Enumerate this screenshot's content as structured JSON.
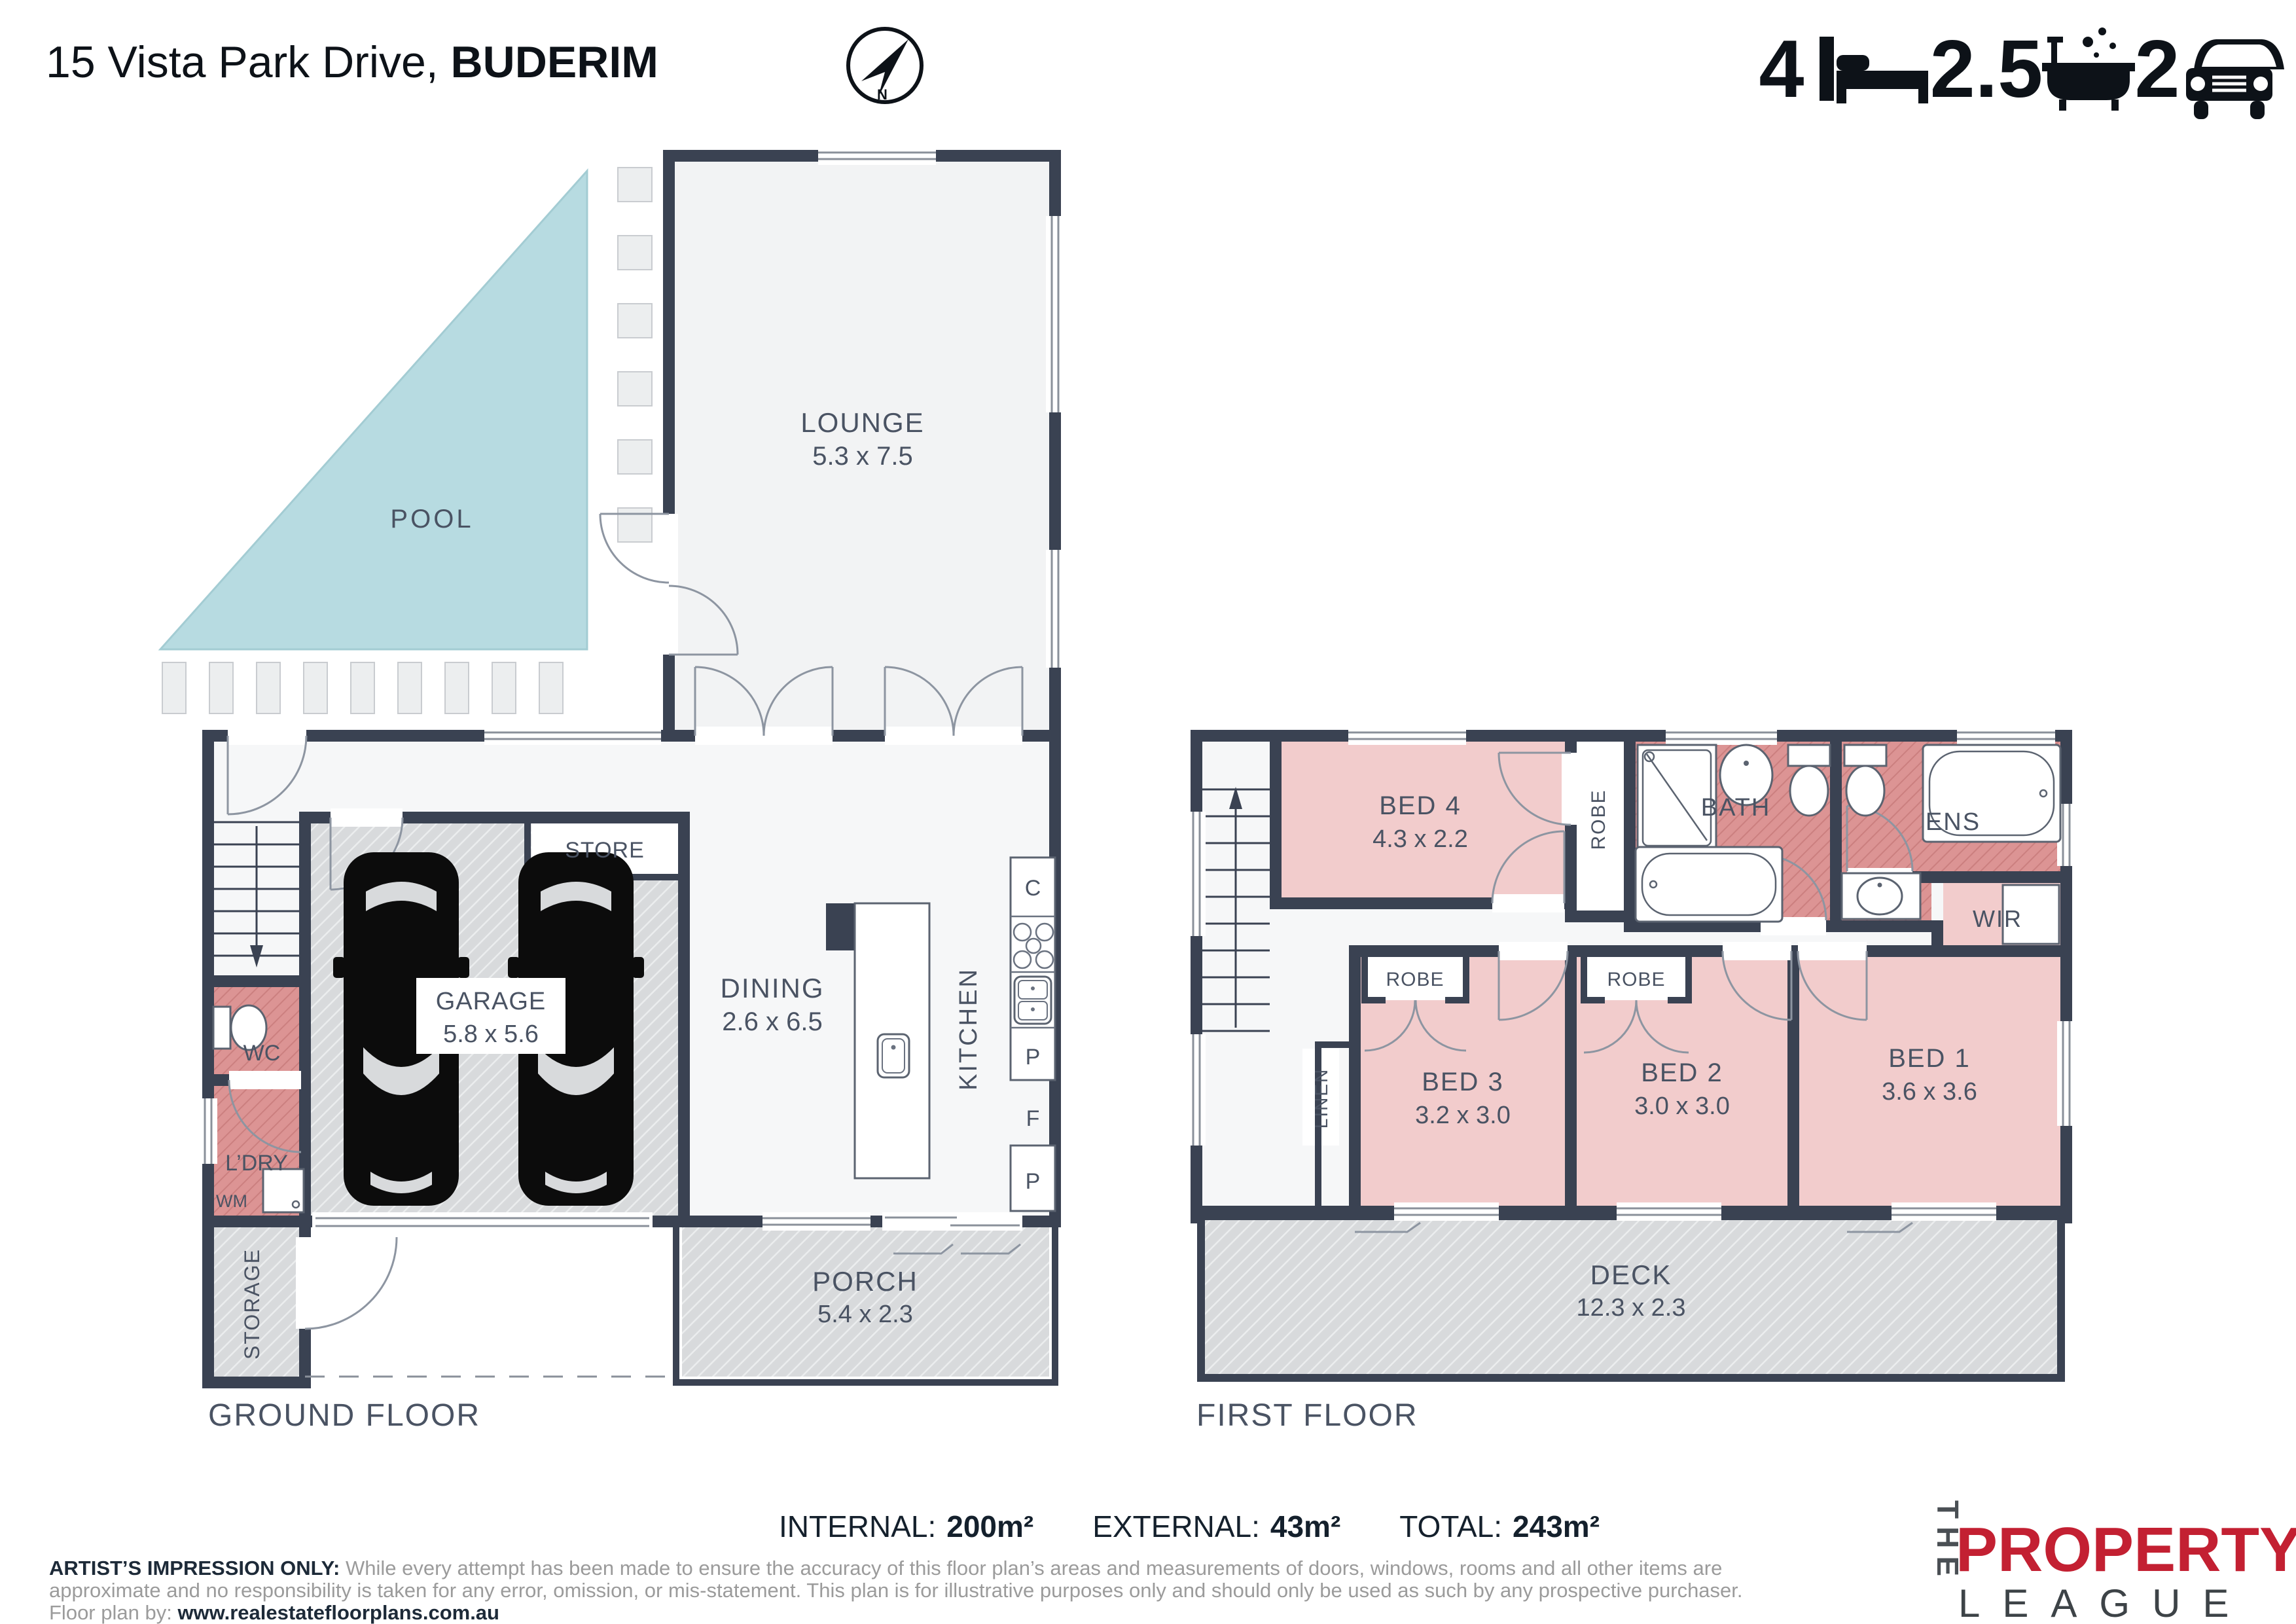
{
  "header": {
    "title_address": "15 Vista Park Drive, ",
    "title_suburb": "BUDERIM",
    "compass_n": "N",
    "stats": {
      "beds": "4",
      "baths": "2.5",
      "cars": "2"
    }
  },
  "ground_floor": {
    "floor_label": "GROUND FLOOR",
    "rooms": {
      "pool": "POOL",
      "lounge": {
        "name": "LOUNGE",
        "dims": "5.3 x 7.5"
      },
      "store": "STORE",
      "garage": {
        "name": "GARAGE",
        "dims": "5.8 x 5.6"
      },
      "dining": {
        "name": "DINING",
        "dims": "2.6 x 6.5"
      },
      "kitchen": "KITCHEN",
      "wc": "WC",
      "laundry": "L’DRY",
      "wm": "WM",
      "storage": "STORAGE",
      "porch": {
        "name": "PORCH",
        "dims": "5.4 x 2.3"
      }
    },
    "kitchen_letters": {
      "c": "C",
      "p1": "P",
      "f": "F",
      "p2": "P"
    }
  },
  "first_floor": {
    "floor_label": "FIRST FLOOR",
    "rooms": {
      "bed4": {
        "name": "BED 4",
        "dims": "4.3 x 2.2"
      },
      "robe": "ROBE",
      "bath": "BATH",
      "ens": "ENS",
      "wir": "WIR",
      "bed3": {
        "name": "BED 3",
        "dims": "3.2 x 3.0"
      },
      "bed2": {
        "name": "BED 2",
        "dims": "3.0 x 3.0"
      },
      "bed1": {
        "name": "BED 1",
        "dims": "3.6 x 3.6"
      },
      "linen": "LINEN",
      "deck": {
        "name": "DECK",
        "dims": "12.3 x 2.3"
      }
    }
  },
  "areas": {
    "internal_label": "INTERNAL:",
    "internal_value": "200m²",
    "external_label": "EXTERNAL:",
    "external_value": "43m²",
    "total_label": "TOTAL:",
    "total_value": "243m²"
  },
  "disclaimer": {
    "bold_intro": "ARTIST’S IMPRESSION ONLY:",
    "line1_rest": " While every attempt has been made to ensure the accuracy of this floor plan’s areas and measurements of doors, windows, rooms and all other items are",
    "line2": "approximate and no responsibility is taken for any error, omission, or mis-statement. This plan is for illustrative purposes only and should only be used as such by any prospective purchaser.",
    "by_label": "Floor plan by: ",
    "by_url": "www.realestatefloorplans.com.au"
  },
  "logo": {
    "the": "THE",
    "property": "PROPERTY",
    "league": "LEAGUE"
  },
  "colors": {
    "wall": "#3a4252",
    "pool": "#b7dbe1",
    "bedroom_pink": "#f2cccc",
    "wet_red": "#dc9494",
    "hatch_gray": "#d8dadc",
    "logo_red": "#c32032"
  }
}
